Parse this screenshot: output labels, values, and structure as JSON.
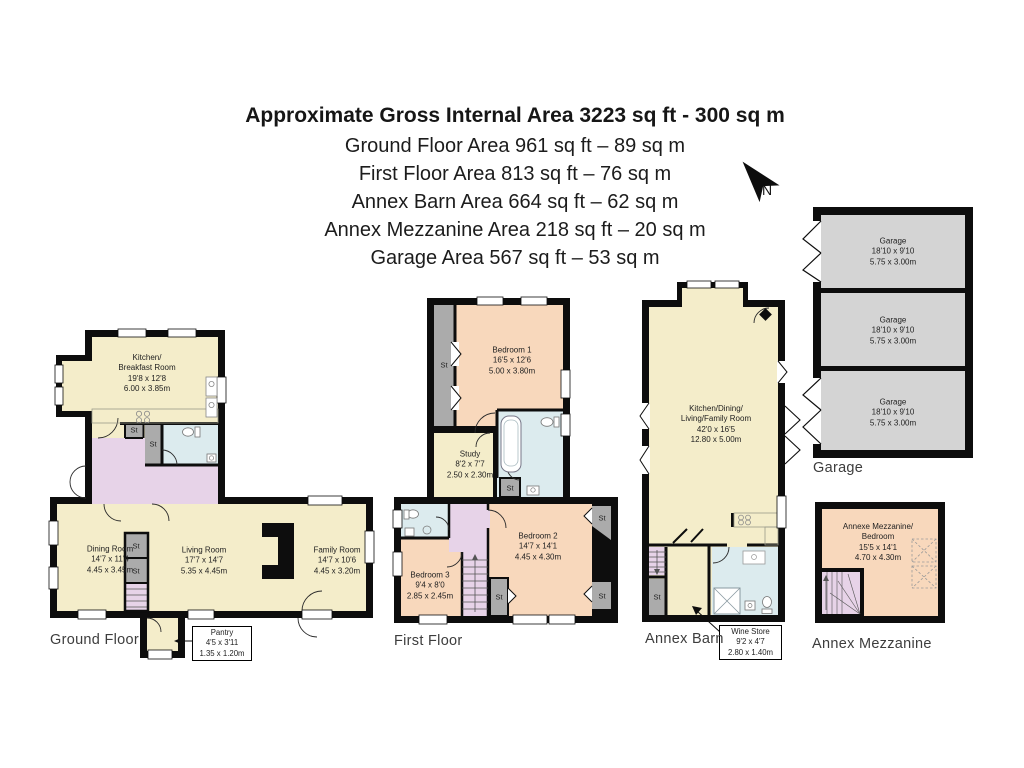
{
  "header": {
    "title": "Approximate Gross Internal Area 3223 sq ft - 300 sq m",
    "subtitle_lines": [
      "Ground Floor Area 961 sq ft – 89 sq m",
      "First Floor Area 813 sq ft – 76 sq m",
      "Annex Barn Area 664 sq ft – 62 sq m",
      "Annex Mezzanine Area 218 sq ft – 20 sq m",
      "Garage Area 567 sq ft – 53 sq m"
    ]
  },
  "compass": {
    "north_label": "N"
  },
  "labels": {
    "st": "St"
  },
  "colors": {
    "wall": "#0d0d0d",
    "cream": "#f4edca",
    "peach": "#f8d8bc",
    "lavender": "#e7d3e8",
    "blue": "#dcebee",
    "storage_gray": "#ababab",
    "garage_gray": "#d4d4d4"
  },
  "plans": {
    "ground_floor": {
      "caption": "Ground Floor",
      "rooms": {
        "kitchen": "Kitchen/\nBreakfast Room\n19'8 x 12'8\n6.00 x 3.85m",
        "dining": "Dining Room\n14'7 x 11'4\n4.45 x 3.45m",
        "living": "Living Room\n17'7 x 14'7\n5.35 x 4.45m",
        "family": "Family Room\n14'7 x 10'6\n4.45 x 3.20m",
        "pantry": "Pantry\n4'5 x 3'11\n1.35 x 1.20m"
      }
    },
    "first_floor": {
      "caption": "First Floor",
      "rooms": {
        "bedroom1": "Bedroom 1\n16'5 x 12'6\n5.00 x 3.80m",
        "study": "Study\n8'2 x 7'7\n2.50 x 2.30m",
        "bedroom2": "Bedroom 2\n14'7 x 14'1\n4.45 x 4.30m",
        "bedroom3": "Bedroom 3\n9'4 x 8'0\n2.85 x 2.45m"
      }
    },
    "annex_barn": {
      "caption": "Annex Barn",
      "rooms": {
        "main": "Kitchen/Dining/\nLiving/Family Room\n42'0 x 16'5\n12.80 x 5.00m",
        "wine_store": "Wine Store\n9'2 x 4'7\n2.80 x 1.40m"
      }
    },
    "annex_mezzanine": {
      "caption": "Annex Mezzanine",
      "rooms": {
        "mezzanine": "Annexe Mezzanine/\nBedroom\n15'5 x 14'1\n4.70 x 4.30m"
      }
    },
    "garage": {
      "caption": "Garage",
      "rooms": {
        "bay": "Garage\n18'10 x 9'10\n5.75 x 3.00m"
      }
    }
  }
}
